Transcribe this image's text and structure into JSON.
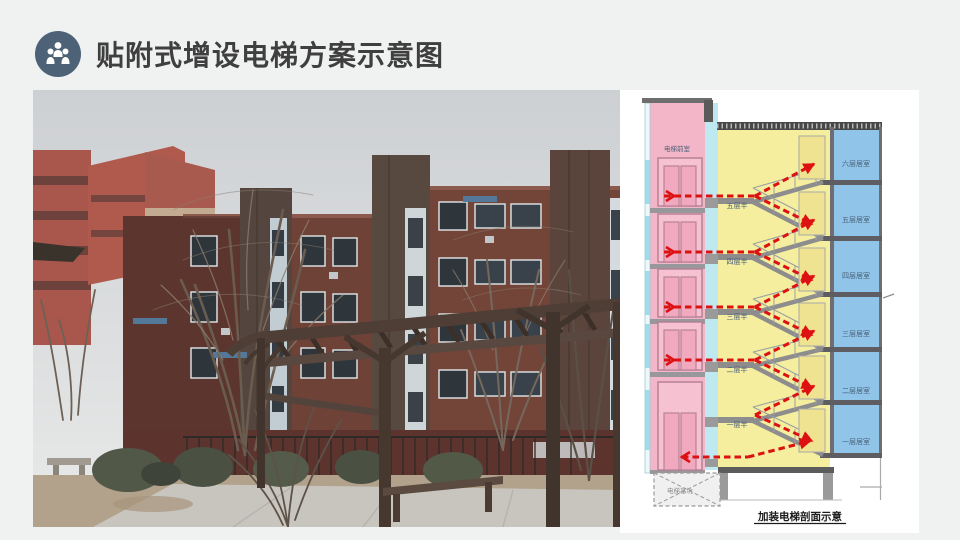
{
  "slide": {
    "background": "#f0f1f1",
    "title": "贴附式增设电梯方案示意图",
    "title_color": "#3f3f3f"
  },
  "header_icon": {
    "name": "people-group-icon",
    "background": "#4d6277",
    "glyph_color": "#ffffff"
  },
  "photo": {
    "name": "residential-courtyard-photo",
    "content": "six-story brick apartment with attached elevator towers, bare trees, wooden pergola"
  },
  "diagram": {
    "caption": "加装电梯剖面示意",
    "elevator_top_label": "电梯前室",
    "pit_label": "电梯基坑",
    "landing_labels": [
      "五层半",
      "四层半",
      "三层半",
      "二层半",
      "一层半"
    ],
    "room_labels": [
      "六层居室",
      "五层居室",
      "四层居室",
      "三层居室",
      "二层居室",
      "一层居室"
    ],
    "colors": {
      "shaft_pink": "#f3b6c8",
      "corridor_cyan": "#bfe9f1",
      "stair_yellow": "#f5ee9e",
      "room_blue": "#90c5e9",
      "slab_gray": "#5e5e62",
      "arrow_red": "#dd1111",
      "label_blue": "#4a6078"
    }
  }
}
